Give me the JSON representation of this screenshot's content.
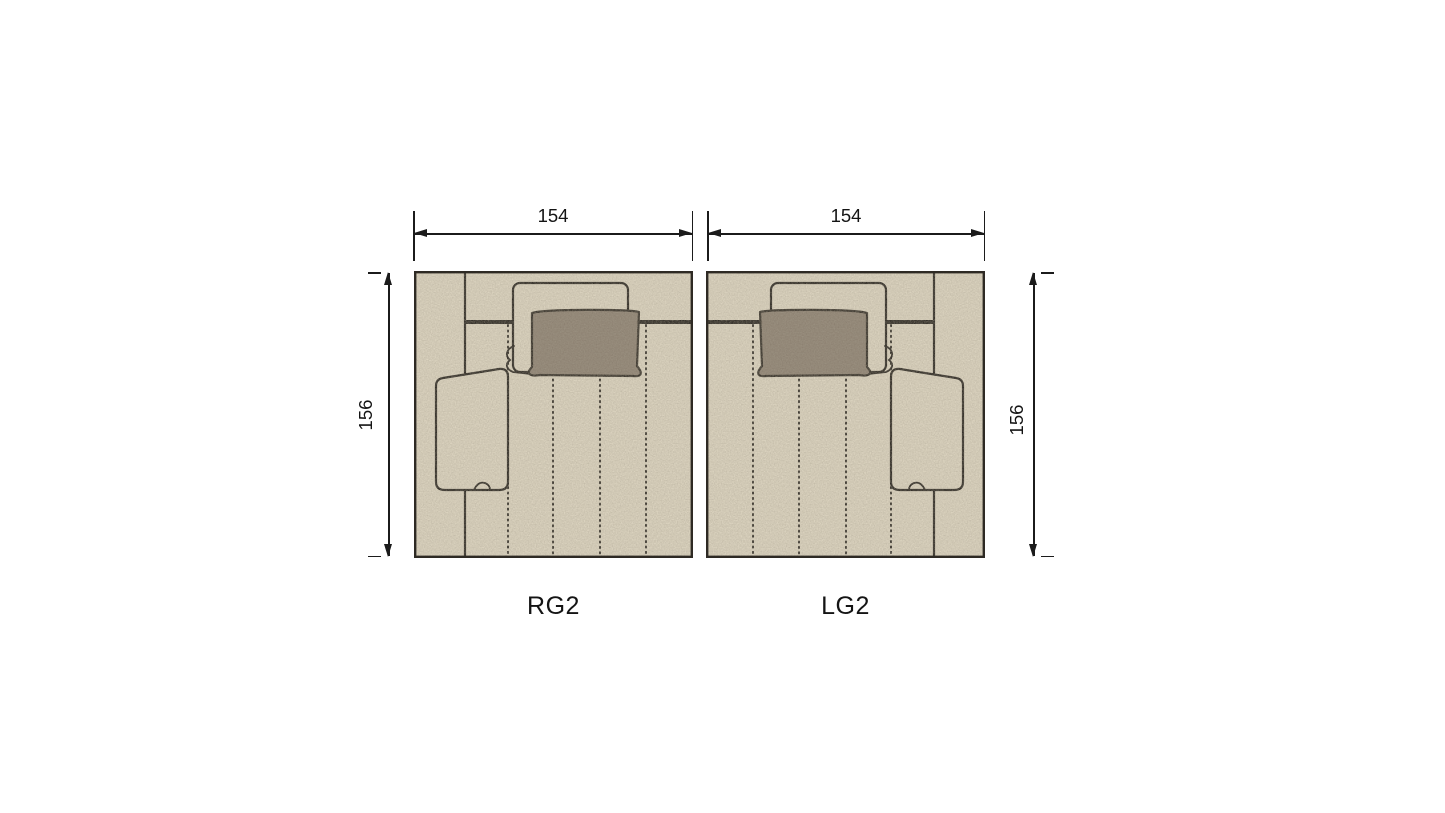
{
  "page": {
    "background": "#ffffff"
  },
  "colors": {
    "background": "#ffffff",
    "fabric": "#dcd4c0",
    "pillow": "#8d8172",
    "line": "#2e2a24",
    "dim": "#1b1b1b",
    "text": "#141414"
  },
  "modules": {
    "rg2": {
      "label": "RG2",
      "width_label": "154",
      "height_label": "156"
    },
    "lg2": {
      "label": "LG2",
      "width_label": "154",
      "height_label": "156"
    }
  }
}
